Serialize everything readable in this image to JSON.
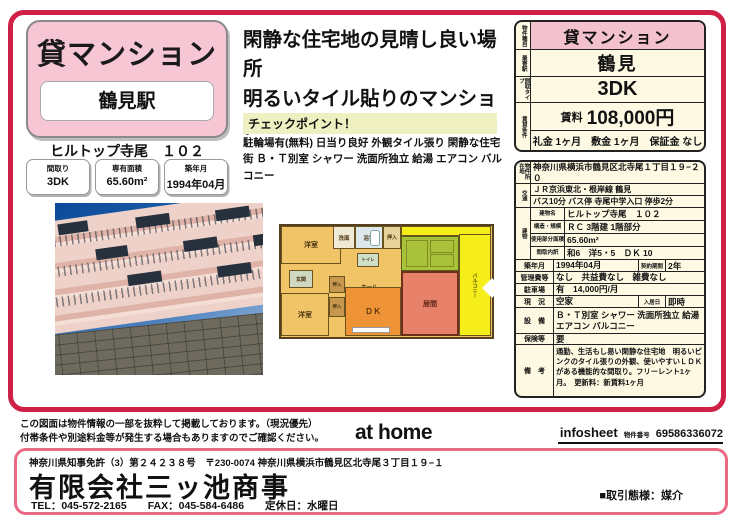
{
  "flyer": {
    "title_box": {
      "category": "貸マンション",
      "station": "鶴見駅"
    },
    "building_name": "ヒルトップ寺尾　１０２",
    "chips": [
      {
        "label": "間取り",
        "value": "3DK"
      },
      {
        "label": "専有面積",
        "value": "65.60m²"
      },
      {
        "label": "築年月",
        "value": "1994年04月"
      }
    ],
    "headline": {
      "line1": "閑静な住宅地の見晴し良い場所",
      "line2": "明るいタイル貼りのマンション"
    },
    "checkpoint": {
      "title": "チェックポイント！",
      "text": "駐輪場有(無料) 日当り良好 外観タイル張り 閑静な住宅街 Ｂ・Ｔ別室 シャワー 洗面所独立 給湯 エアコン バルコニー"
    }
  },
  "summary": {
    "rows": [
      {
        "label": "物件種目",
        "value": "貸マンション"
      },
      {
        "label": "最寄駅",
        "value": "鶴見"
      },
      {
        "label": "間取タイプ",
        "value": "3DK"
      },
      {
        "label": "賃貸条件",
        "rent_label": "賃料",
        "rent_value": "108,000円",
        "terms": "礼金 1ヶ月　敷金 1ヶ月　保証金 なし"
      }
    ]
  },
  "details": {
    "address_label": "物件所在地",
    "address": "神奈川県横浜市鶴見区北寺尾１丁目１９−２０",
    "traffic_label": "交通",
    "traffic_line1": "ＪＲ京浜東北・根岸線 鶴見",
    "traffic_line2": "バス10分 バス停 寺尾中学入口 停歩2分",
    "building_label": "建物",
    "building_rows": [
      {
        "label": "建物名",
        "value": "ヒルトップ寺尾　１０２"
      },
      {
        "label": "構造・規模",
        "value": "ＲＣ 3階建 1階部分"
      },
      {
        "label": "使用部分面積",
        "value": "65.60m²"
      },
      {
        "label": "間取内訳",
        "value": "和6　洋5・5　ＤＫ 10"
      }
    ],
    "built_label": "築年月",
    "built": "1994年04月",
    "contract_label": "契約期間",
    "contract": "2年",
    "fees_label": "管理費等",
    "fees": "なし　共益費なし　雑費なし",
    "parking_label": "駐車場",
    "parking": "有　14,000円/月",
    "status_label": "現　況",
    "status": "空家",
    "movein_label": "入居日",
    "movein": "即時",
    "equipment_label": "設　備",
    "equipment": "Ｂ・Ｔ別室 シャワー 洗面所独立 給湯 エアコン バルコニー",
    "insurance_label": "保険等",
    "insurance": "要",
    "remarks_label": "備　考",
    "remarks": "通勤、生活もし易い閑静な住宅地　明るいピンクのタイル張りの外観、使いやすいＬＤＫがある機能的な間取り。フリーレント1ヶ月。　更新料：新賃料1ヶ月"
  },
  "floorplan": {
    "rooms": [
      {
        "label": "洋室"
      },
      {
        "label": "洗面"
      },
      {
        "label": "浴室"
      },
      {
        "label": "押入"
      },
      {
        "label": "トイレ"
      },
      {
        "label": "ホール"
      },
      {
        "label": "玄関"
      },
      {
        "label": "押入"
      },
      {
        "label": "押入"
      },
      {
        "label": "洋室"
      },
      {
        "label": "ＤＫ"
      },
      {
        "label": "居間"
      },
      {
        "label": "バルコニー"
      }
    ]
  },
  "footer": {
    "disclaimer_line1": "この図面は物件情報の一部を抜粋して掲載しております。（現況優先）",
    "disclaimer_line2": "付帯条件や別途料金等が発生する場合もありますのでご確認ください。",
    "logo_text": "at home",
    "infosheet_label": "infosheet",
    "property_no_label": "物件番号",
    "property_no": "69586336072"
  },
  "company": {
    "license": "神奈川県知事免許（3）第２４２３８号　〒230-0074 神奈川県横浜市鶴見区北寺尾３丁目１９−１",
    "name": "有限会社三ッ池商事",
    "contact": "TEL：045-572-2165　　FAX：045-584-6486　　定休日：水曜日",
    "transaction": "■取引態様：媒介"
  },
  "colors": {
    "frame_red": "#cf2146",
    "title_pink": "#f6c6d4",
    "table_cream": "#fdf9e3",
    "header_pink": "#f3c0ce",
    "checkpoint_yellow": "#eff0c2",
    "company_border_pink": "#e86a84",
    "balcony_yellow": "#f6ee18",
    "tatami_green": "#a9c23a",
    "room_tan": "#f2c468",
    "dk_orange": "#ef9436",
    "living_salmon": "#e8816a"
  }
}
